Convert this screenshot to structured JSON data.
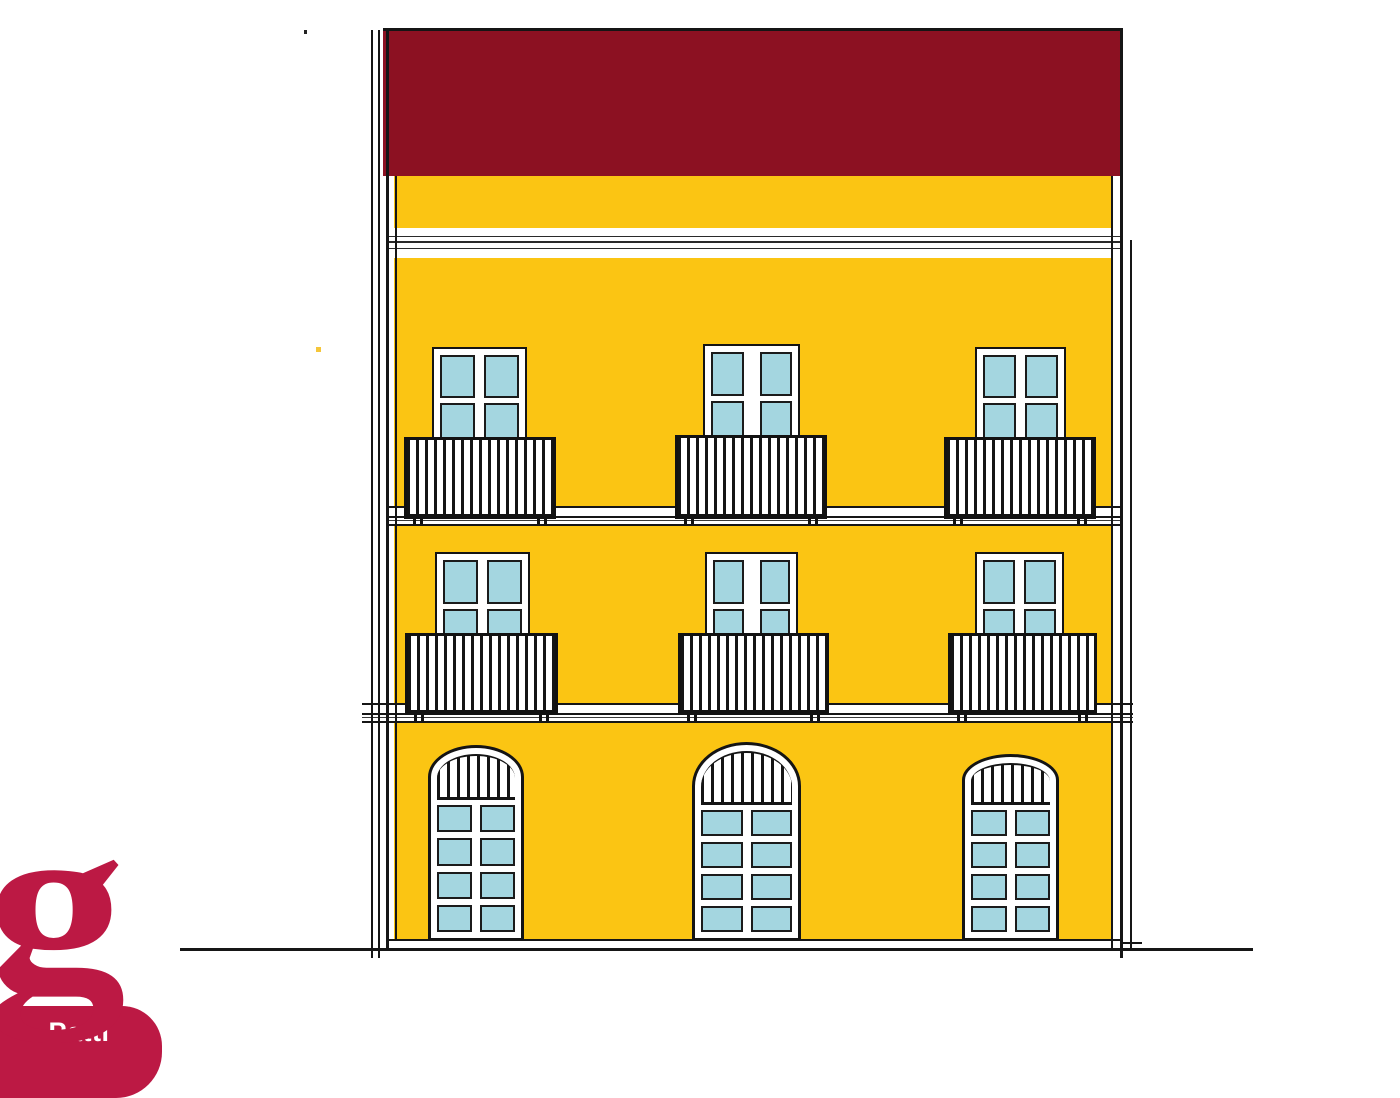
{
  "title": "Building facade elevation drawing",
  "colors": {
    "paper": "#ffffff",
    "facade_yellow": "#FBC513",
    "roof_red": "#8C1122",
    "pane_blue": "#A4D6E0",
    "logo_crimson": "#BC1944",
    "ink": "#161616"
  },
  "logo": {
    "glyph": "g",
    "label": "Patti"
  },
  "elevation": {
    "roof": {
      "x": 383,
      "y": 28,
      "w": 739,
      "h": 148
    },
    "wall": {
      "x": 394,
      "y": 176,
      "w": 718,
      "h": 765
    },
    "cornice": {
      "x": 386,
      "y": 228,
      "w": 736,
      "h": 30,
      "lines": [
        {
          "t": 8,
          "h": 1
        },
        {
          "t": 13,
          "h": 2
        },
        {
          "t": 20,
          "h": 1
        }
      ]
    },
    "bands": [
      {
        "x": 386,
        "y": 506,
        "w": 736,
        "h": 20
      },
      {
        "x": 362,
        "y": 703,
        "w": 771,
        "h": 20
      }
    ],
    "edge_lines": [
      {
        "x": 371,
        "y": 30,
        "w": 2,
        "h": 928
      },
      {
        "x": 378,
        "y": 30,
        "w": 2,
        "h": 928
      },
      {
        "x": 386,
        "y": 28,
        "w": 3,
        "h": 922
      },
      {
        "x": 395,
        "y": 176,
        "w": 2,
        "h": 765
      },
      {
        "x": 1111,
        "y": 176,
        "w": 2,
        "h": 774
      },
      {
        "x": 1120,
        "y": 28,
        "w": 3,
        "h": 930
      },
      {
        "x": 1130,
        "y": 240,
        "w": 2,
        "h": 710
      }
    ],
    "base_line": {
      "x": 386,
      "y": 939,
      "w": 736,
      "h": 2
    },
    "ground_line": {
      "x": 180,
      "y": 948,
      "w": 1073,
      "h": 3
    },
    "ground_tick": {
      "x": 1120,
      "y": 942,
      "w": 22,
      "h": 2
    },
    "windows": [
      {
        "x": 432,
        "y": 347,
        "w": 95,
        "h": 156,
        "mull": 9
      },
      {
        "x": 703,
        "y": 344,
        "w": 97,
        "h": 159,
        "mull": 16
      },
      {
        "x": 975,
        "y": 347,
        "w": 91,
        "h": 156,
        "mull": 9
      },
      {
        "x": 435,
        "y": 552,
        "w": 95,
        "h": 157,
        "mull": 9
      },
      {
        "x": 705,
        "y": 552,
        "w": 93,
        "h": 157,
        "mull": 16
      },
      {
        "x": 975,
        "y": 552,
        "w": 89,
        "h": 157,
        "mull": 9
      }
    ],
    "balconies": [
      {
        "x": 404,
        "y": 437,
        "w": 152,
        "h": 82
      },
      {
        "x": 675,
        "y": 435,
        "w": 152,
        "h": 84
      },
      {
        "x": 944,
        "y": 437,
        "w": 152,
        "h": 82
      },
      {
        "x": 405,
        "y": 633,
        "w": 153,
        "h": 82
      },
      {
        "x": 678,
        "y": 633,
        "w": 151,
        "h": 82
      },
      {
        "x": 948,
        "y": 633,
        "w": 149,
        "h": 82
      }
    ],
    "doors": [
      {
        "x": 428,
        "y": 745,
        "w": 96,
        "h": 196,
        "archH": 32,
        "fanH": 46
      },
      {
        "x": 692,
        "y": 742,
        "w": 109,
        "h": 199,
        "archH": 44,
        "fanH": 54
      },
      {
        "x": 962,
        "y": 754,
        "w": 97,
        "h": 187,
        "archH": 26,
        "fanH": 42
      }
    ],
    "specks": [
      {
        "x": 304,
        "y": 30,
        "w": 3,
        "h": 4,
        "color": "#222222"
      },
      {
        "x": 316,
        "y": 347,
        "w": 5,
        "h": 5,
        "color": "#f5c63a"
      }
    ]
  }
}
